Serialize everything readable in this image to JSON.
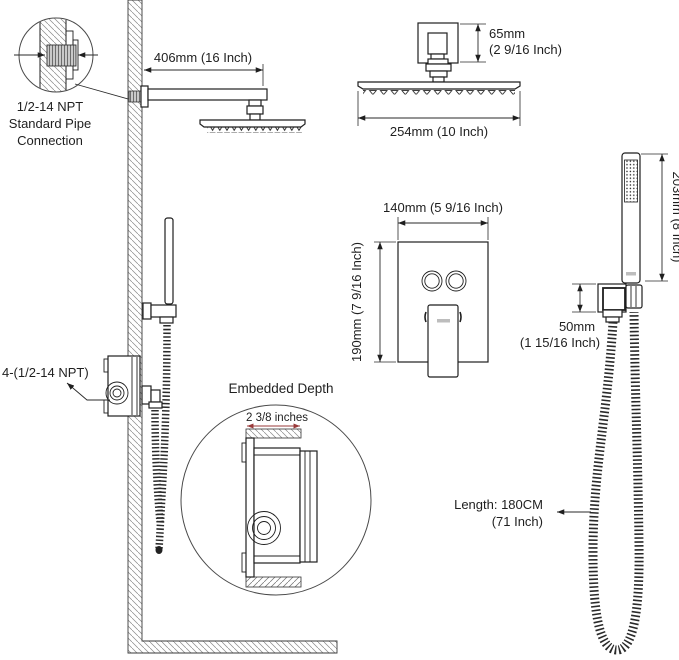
{
  "colors": {
    "ink": "#1f1f1f",
    "dim_line": "#2a2a2a",
    "accent_red": "#993a3a",
    "hatch_gray": "#8a8a8a",
    "thread_fill": "#c9c9c9"
  },
  "callout_pipe": {
    "line1": "1/2-14 NPT",
    "line2": "Standard Pipe",
    "line3": "Connection"
  },
  "dimensions": {
    "arm_length": "406mm (16 Inch)",
    "head_height_mm": "65mm",
    "head_height_inch": "(2 9/16 Inch)",
    "head_width": "254mm (10 Inch)",
    "valve_width": "140mm (5 9/16 Inch)",
    "valve_height": "190mm (7 9/16 Inch)",
    "wand_length": "203mm (8 Inch)",
    "holder_offset_mm": "50mm",
    "holder_offset_inch": "(1 15/16 Inch)",
    "hose_length_line1": "Length: 180CM",
    "hose_length_line2": "(71 Inch)",
    "embedded_depth": "2 3/8 inches",
    "valve_ports": "4-(1/2-14 NPT)"
  },
  "sections": {
    "embedded_title": "Embedded Depth"
  }
}
